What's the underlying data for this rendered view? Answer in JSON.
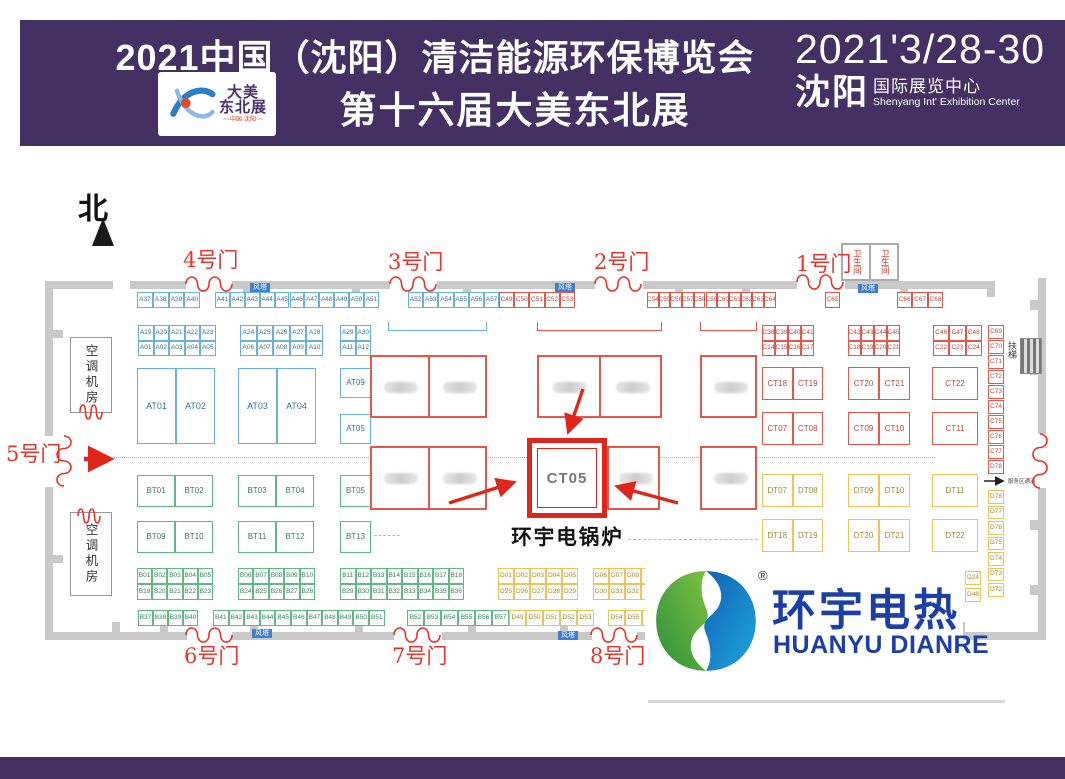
{
  "header": {
    "title_line1": "2021中国（沈阳）清洁能源环保博览会",
    "title_line2": "第十六届大美东北展",
    "logo_line1": "大美",
    "logo_line2": "东北展",
    "logo_sub": "~~中国·沈阳~~",
    "date": "2021'3/28-30",
    "venue_cn": "沈阳",
    "venue_suffix": "国际展览中心",
    "venue_en": "Shenyang Int' Exhibition Center",
    "bg_color": "#443063"
  },
  "brand": {
    "name_cn": "环宇电热",
    "name_en": "HUANYU DIANRE",
    "registered": "®",
    "blue": "#1b3fa6",
    "green": "#2e8f3c"
  },
  "plan": {
    "north_label": "北",
    "wind_tower_label": "风塔",
    "ac_room_label": "空调机房",
    "toilet_label": "卫生间",
    "escalator_label": "扶梯",
    "service_label": "服务区通道",
    "highlight": {
      "booth": "CT05",
      "caption": "环宇电锅炉"
    },
    "colors": {
      "door_red": "#e8322a",
      "highlight_red": "#e0251b",
      "booth_blue": "#64b2dd",
      "booth_green": "#5cbc80",
      "booth_red": "#e8564a",
      "booth_yellow": "#eec455",
      "badge_blue": "#3f7fd0",
      "wall_grey": "#c9c9c9"
    },
    "doors": [
      {
        "label": "4号门",
        "x": 186,
        "y": 276,
        "len": 46,
        "lx": 183,
        "ly": 250
      },
      {
        "label": "3号门",
        "x": 390,
        "y": 276,
        "len": 46,
        "lx": 388,
        "ly": 252
      },
      {
        "label": "2号门",
        "x": 595,
        "y": 276,
        "len": 46,
        "lx": 594,
        "ly": 252
      },
      {
        "label": "1号门",
        "x": 797,
        "y": 274,
        "len": 46,
        "lx": 796,
        "ly": 254
      },
      {
        "label": "5号门",
        "x": 56,
        "y": 436,
        "len": 50,
        "v": true,
        "lx": 6,
        "ly": 444
      },
      {
        "label": "6号门",
        "x": 186,
        "y": 627,
        "len": 46,
        "lx": 184,
        "ly": 646
      },
      {
        "label": "7号门",
        "x": 394,
        "y": 627,
        "len": 46,
        "lx": 392,
        "ly": 646
      },
      {
        "label": "8号门",
        "x": 591,
        "y": 627,
        "len": 46,
        "lx": 590,
        "ly": 646
      },
      {
        "label": "",
        "x": 1032,
        "y": 434,
        "len": 54,
        "v": true
      },
      {
        "label": "",
        "x": 80,
        "y": 404,
        "len": 22
      },
      {
        "label": "",
        "x": 78,
        "y": 508,
        "len": 22
      }
    ],
    "badges": [
      {
        "x": 250,
        "y": 283
      },
      {
        "x": 555,
        "y": 283
      },
      {
        "x": 858,
        "y": 284
      },
      {
        "x": 252,
        "y": 629
      },
      {
        "x": 558,
        "y": 631
      }
    ],
    "booth_groups": [
      {
        "color": "blue",
        "x": 137,
        "y": 292,
        "w": 15.8,
        "h": 16,
        "cols": 4,
        "labels": [
          "A37",
          "A38",
          "A39",
          "A40"
        ]
      },
      {
        "color": "blue",
        "x": 215,
        "y": 292,
        "w": 14.9,
        "h": 16,
        "cols": 11,
        "labels": [
          "A41",
          "A42",
          "A43",
          "A44",
          "A45",
          "A46",
          "A47",
          "A48",
          "A49",
          "A50",
          "A51"
        ]
      },
      {
        "color": "blue",
        "x": 408,
        "y": 292,
        "w": 15.2,
        "h": 16,
        "cols": 6,
        "labels": [
          "A52",
          "A53",
          "A54",
          "A55",
          "A56",
          "A57"
        ]
      },
      {
        "color": "red",
        "x": 499,
        "y": 292,
        "w": 15.2,
        "h": 16,
        "cols": 5,
        "labels": [
          "C49",
          "C50",
          "C51",
          "C52",
          "C53"
        ]
      },
      {
        "color": "red",
        "x": 647,
        "y": 292,
        "w": 11.7,
        "h": 16,
        "cols": 11,
        "labels": [
          "C54",
          "C55",
          "C56",
          "C57",
          "C58",
          "C59",
          "C60",
          "C61",
          "C62",
          "C63",
          "C64"
        ]
      },
      {
        "color": "red",
        "x": 825,
        "y": 292,
        "w": 15,
        "h": 16,
        "cols": 1,
        "labels": [
          "C65"
        ]
      },
      {
        "color": "red",
        "x": 897,
        "y": 292,
        "w": 15.4,
        "h": 16,
        "cols": 3,
        "labels": [
          "C66",
          "C67",
          "C68"
        ]
      },
      {
        "color": "blue",
        "x": 138,
        "y": 325,
        "w": 15.5,
        "h": 15.5,
        "cols": 5,
        "labels": [
          "A19",
          "A20",
          "A21",
          "A22",
          "A23",
          "A01",
          "A02",
          "A03",
          "A04",
          "A05"
        ]
      },
      {
        "color": "blue",
        "x": 240,
        "y": 325,
        "w": 16.6,
        "h": 15.5,
        "cols": 5,
        "labels": [
          "A24",
          "A25",
          "A26",
          "A27",
          "A28",
          "A06",
          "A07",
          "A08",
          "A09",
          "A10"
        ]
      },
      {
        "color": "blue",
        "x": 340,
        "y": 325,
        "w": 15.5,
        "h": 15.5,
        "cols": 2,
        "labels": [
          "A29",
          "A30",
          "A11",
          "A12"
        ]
      },
      {
        "color": "red",
        "x": 762,
        "y": 325,
        "w": 13,
        "h": 15.5,
        "cols": 4,
        "labels": [
          "C38",
          "C39",
          "C40",
          "C41",
          "C14",
          "C15",
          "C16",
          "C17"
        ]
      },
      {
        "color": "red",
        "x": 848,
        "y": 325,
        "w": 13,
        "h": 15.5,
        "cols": 4,
        "labels": [
          "C42",
          "C43",
          "C44",
          "C45",
          "C18",
          "C19",
          "C20",
          "C21"
        ]
      },
      {
        "color": "red",
        "x": 933,
        "y": 325,
        "w": 16.3,
        "h": 15.5,
        "cols": 3,
        "labels": [
          "C46",
          "C47",
          "C48",
          "C22",
          "C23",
          "C24"
        ]
      },
      {
        "color": "red",
        "x": 988,
        "y": 325,
        "w": 16,
        "h": 13.5,
        "gy": 1.5,
        "cols": 1,
        "labels": [
          "C69",
          "C70",
          "C71",
          "C72",
          "C73",
          "C74",
          "C75",
          "C76",
          "C77",
          "D78"
        ]
      },
      {
        "color": "yellow",
        "x": 988,
        "y": 490,
        "w": 16,
        "h": 13.5,
        "gy": 2,
        "cols": 1,
        "labels": [
          "D78",
          "D77",
          "D76",
          "D75",
          "D74",
          "D73",
          "D72"
        ]
      },
      {
        "color": "yellow",
        "x": 965,
        "y": 571,
        "w": 16,
        "h": 14,
        "gy": 3,
        "cols": 1,
        "labels": [
          "D24",
          "D48"
        ]
      },
      {
        "color": "blue",
        "x": 137,
        "y": 368,
        "w": 39,
        "h": 76,
        "cols": 2,
        "fs": 9,
        "labels": [
          "AT01",
          "AT02"
        ]
      },
      {
        "color": "blue",
        "x": 238,
        "y": 368,
        "w": 39,
        "h": 76,
        "cols": 2,
        "fs": 9,
        "labels": [
          "AT03",
          "AT04"
        ]
      },
      {
        "color": "blue",
        "x": 340,
        "y": 368,
        "w": 31,
        "h": 30,
        "cols": 1,
        "fs": 8,
        "labels": [
          "AT09"
        ]
      },
      {
        "color": "blue",
        "x": 340,
        "y": 414,
        "w": 31,
        "h": 30,
        "cols": 1,
        "fs": 8,
        "labels": [
          "AT05"
        ]
      },
      {
        "color": "green",
        "x": 137,
        "y": 475,
        "w": 38,
        "h": 32,
        "cols": 2,
        "fs": 8,
        "labels": [
          "BT01",
          "BT02"
        ]
      },
      {
        "color": "green",
        "x": 238,
        "y": 475,
        "w": 38,
        "h": 32,
        "cols": 2,
        "fs": 8,
        "labels": [
          "BT03",
          "BT04"
        ]
      },
      {
        "color": "green",
        "x": 340,
        "y": 475,
        "w": 31,
        "h": 32,
        "cols": 1,
        "fs": 8,
        "labels": [
          "BT05"
        ]
      },
      {
        "color": "green",
        "x": 137,
        "y": 521,
        "w": 38,
        "h": 32,
        "cols": 2,
        "fs": 8,
        "labels": [
          "BT09",
          "BT10"
        ]
      },
      {
        "color": "green",
        "x": 238,
        "y": 521,
        "w": 38,
        "h": 32,
        "cols": 2,
        "fs": 8,
        "labels": [
          "BT11",
          "BT12"
        ]
      },
      {
        "color": "green",
        "x": 340,
        "y": 521,
        "w": 31,
        "h": 32,
        "cols": 1,
        "fs": 8,
        "labels": [
          "BT13"
        ]
      },
      {
        "color": "red",
        "x": 762,
        "y": 367,
        "w": 30.5,
        "h": 33,
        "cols": 2,
        "fs": 8,
        "labels": [
          "CT18",
          "CT19"
        ]
      },
      {
        "color": "red",
        "x": 848,
        "y": 367,
        "w": 31,
        "h": 33,
        "cols": 2,
        "fs": 8,
        "labels": [
          "CT20",
          "CT21"
        ]
      },
      {
        "color": "red",
        "x": 932,
        "y": 367,
        "w": 46,
        "h": 33,
        "cols": 1,
        "fs": 8,
        "labels": [
          "CT22"
        ]
      },
      {
        "color": "red",
        "x": 762,
        "y": 412,
        "w": 30.5,
        "h": 33,
        "cols": 2,
        "fs": 8,
        "labels": [
          "CT07",
          "CT08"
        ]
      },
      {
        "color": "red",
        "x": 848,
        "y": 412,
        "w": 31,
        "h": 33,
        "cols": 2,
        "fs": 8,
        "labels": [
          "CT09",
          "CT10"
        ]
      },
      {
        "color": "red",
        "x": 932,
        "y": 412,
        "w": 46,
        "h": 33,
        "cols": 1,
        "fs": 8,
        "labels": [
          "CT11"
        ]
      },
      {
        "color": "yellow",
        "x": 762,
        "y": 474,
        "w": 30.5,
        "h": 33,
        "cols": 2,
        "fs": 8,
        "labels": [
          "DT07",
          "DT08"
        ]
      },
      {
        "color": "yellow",
        "x": 848,
        "y": 474,
        "w": 31,
        "h": 33,
        "cols": 2,
        "fs": 8,
        "labels": [
          "DT09",
          "DT10"
        ]
      },
      {
        "color": "yellow",
        "x": 932,
        "y": 474,
        "w": 46,
        "h": 33,
        "cols": 1,
        "fs": 8,
        "labels": [
          "DT11"
        ]
      },
      {
        "color": "yellow",
        "x": 762,
        "y": 519,
        "w": 30.5,
        "h": 33,
        "cols": 2,
        "fs": 8,
        "labels": [
          "DT18",
          "DT19"
        ]
      },
      {
        "color": "yellow",
        "x": 848,
        "y": 519,
        "w": 31,
        "h": 33,
        "cols": 2,
        "fs": 8,
        "labels": [
          "DT20",
          "DT21"
        ]
      },
      {
        "color": "yellow",
        "x": 932,
        "y": 519,
        "w": 46,
        "h": 33,
        "cols": 1,
        "fs": 8,
        "labels": [
          "DT22"
        ]
      },
      {
        "color": "green",
        "x": 137,
        "y": 568,
        "w": 15.2,
        "h": 16,
        "cols": 5,
        "labels": [
          "B01",
          "B02",
          "B03",
          "B04",
          "B05",
          "B19",
          "B20",
          "B21",
          "B22",
          "B23"
        ]
      },
      {
        "color": "green",
        "x": 238,
        "y": 568,
        "w": 15.4,
        "h": 16,
        "cols": 5,
        "labels": [
          "B06",
          "B07",
          "B08",
          "B09",
          "B10",
          "B24",
          "B25",
          "B26",
          "B27",
          "B28"
        ]
      },
      {
        "color": "green",
        "x": 340,
        "y": 568,
        "w": 15.5,
        "h": 16,
        "cols": 8,
        "labels": [
          "B11",
          "B12",
          "B13",
          "B14",
          "B15",
          "B16",
          "B17",
          "B18",
          "B29",
          "B30",
          "B31",
          "B32",
          "B33",
          "B34",
          "B35",
          "B36"
        ]
      },
      {
        "color": "yellow",
        "x": 498,
        "y": 568,
        "w": 16,
        "h": 16,
        "cols": 5,
        "labels": [
          "D01",
          "D02",
          "D03",
          "D04",
          "D05",
          "D25",
          "D26",
          "D27",
          "D28",
          "D29"
        ]
      },
      {
        "color": "yellow",
        "x": 593,
        "y": 568,
        "w": 16,
        "h": 16,
        "cols": 4,
        "labels": [
          "D06",
          "D07",
          "D08",
          "",
          "D30",
          "D31",
          "D32",
          ""
        ]
      },
      {
        "color": "green",
        "x": 138,
        "y": 610,
        "w": 15,
        "h": 16,
        "cols": 4,
        "labels": [
          "B37",
          "B38",
          "B39",
          "B40"
        ]
      },
      {
        "color": "green",
        "x": 213,
        "y": 610,
        "w": 15.6,
        "h": 16,
        "cols": 11,
        "labels": [
          "B41",
          "B42",
          "B43",
          "B44",
          "B45",
          "B46",
          "B47",
          "B48",
          "B49",
          "B50",
          "B51"
        ]
      },
      {
        "color": "green",
        "x": 407,
        "y": 610,
        "w": 17,
        "h": 16,
        "cols": 6,
        "labels": [
          "B52",
          "B53",
          "B54",
          "B55",
          "B56",
          "B57"
        ]
      },
      {
        "color": "yellow",
        "x": 509,
        "y": 610,
        "w": 17,
        "h": 16,
        "cols": 5,
        "labels": [
          "D49",
          "D50",
          "D51",
          "D52",
          "D53"
        ]
      },
      {
        "color": "yellow",
        "x": 608,
        "y": 610,
        "w": 17,
        "h": 16,
        "cols": 3,
        "labels": [
          "D54",
          "D55",
          ""
        ]
      }
    ],
    "blocks": [
      {
        "x": 370,
        "y": 355,
        "w": 117,
        "h": 63,
        "split": true
      },
      {
        "x": 537,
        "y": 355,
        "w": 125,
        "h": 63,
        "split": true
      },
      {
        "x": 700,
        "y": 355,
        "w": 57,
        "h": 63
      },
      {
        "x": 370,
        "y": 446,
        "w": 117,
        "h": 64,
        "split": true
      },
      {
        "x": 607,
        "y": 446,
        "w": 53,
        "h": 64
      },
      {
        "x": 700,
        "y": 446,
        "w": 57,
        "h": 64
      }
    ]
  }
}
